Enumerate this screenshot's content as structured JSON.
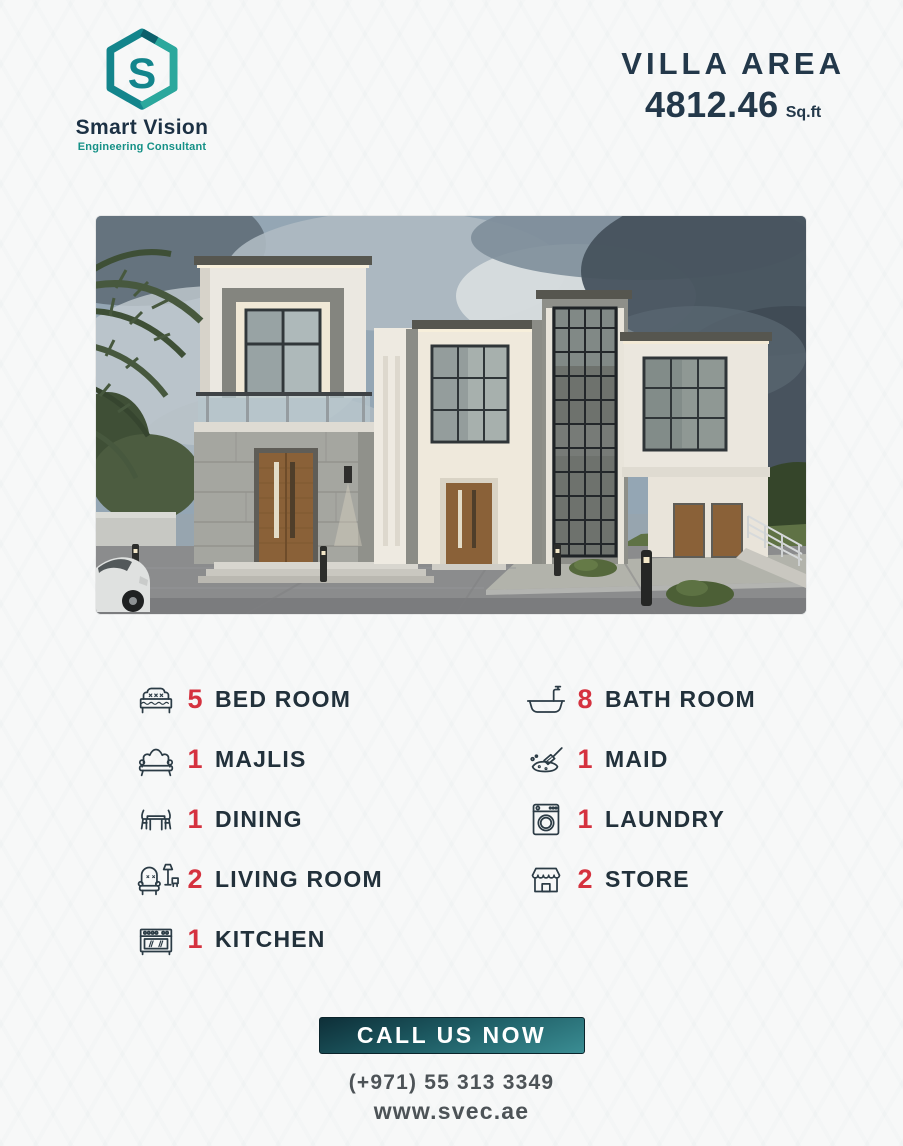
{
  "brand": {
    "name": "Smart Vision",
    "tagline": "Engineering Consultant",
    "monogram": "S"
  },
  "area": {
    "title": "VILLA AREA",
    "value": "4812.46",
    "unit": "Sq.ft"
  },
  "features": {
    "left": [
      {
        "count": "5",
        "label": "BED ROOM",
        "icon": "bed-icon"
      },
      {
        "count": "1",
        "label": "MAJLIS",
        "icon": "sofa-icon"
      },
      {
        "count": "1",
        "label": "DINING",
        "icon": "dining-icon"
      },
      {
        "count": "2",
        "label": "LIVING ROOM",
        "icon": "living-room-icon"
      },
      {
        "count": "1",
        "label": "KITCHEN",
        "icon": "stove-icon"
      }
    ],
    "right": [
      {
        "count": "8",
        "label": "BATH ROOM",
        "icon": "bathtub-icon"
      },
      {
        "count": "1",
        "label": "MAID",
        "icon": "cleaning-icon"
      },
      {
        "count": "1",
        "label": "LAUNDRY",
        "icon": "washing-machine-icon"
      },
      {
        "count": "2",
        "label": "STORE",
        "icon": "storefront-icon"
      }
    ]
  },
  "cta": {
    "button": "CALL US NOW",
    "phone": "(+971) 55 313 3349",
    "website": "www.svec.ae"
  },
  "colors": {
    "accent_red": "#d5323f",
    "navy": "#23384a",
    "teal": "#149086",
    "button_gradient_top": "#0e2f38",
    "button_gradient_bottom": "#3a8d93"
  }
}
